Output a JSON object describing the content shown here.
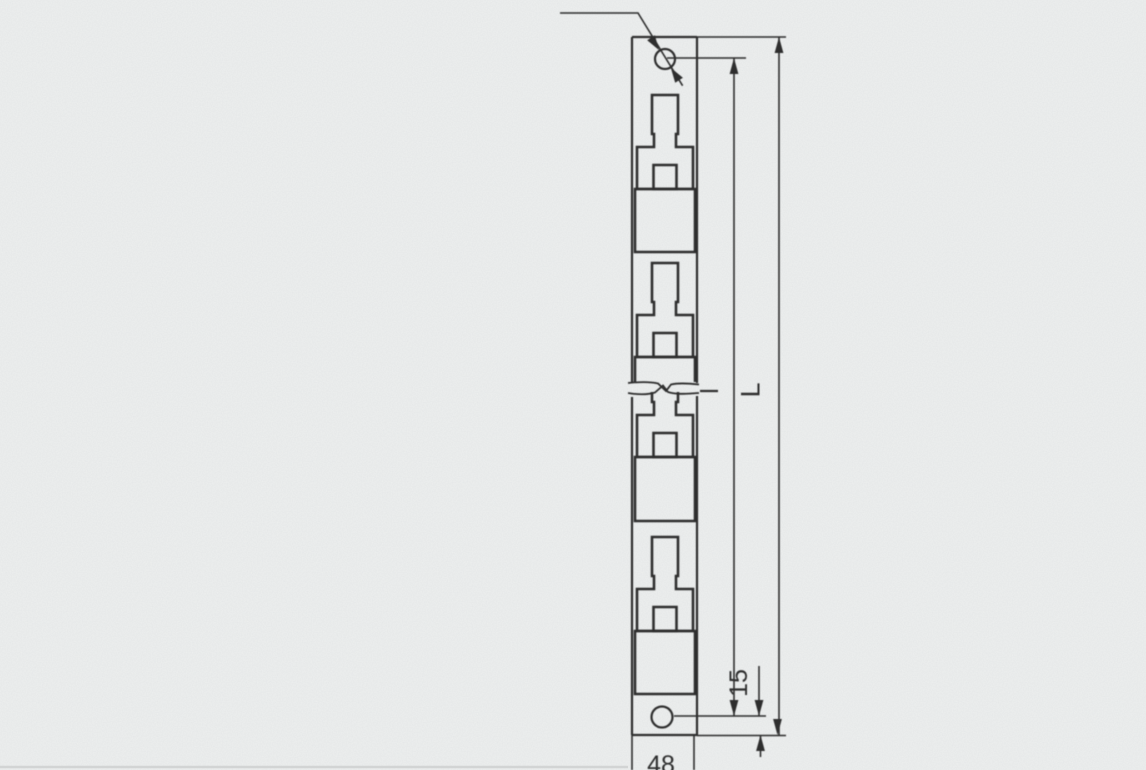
{
  "page": {
    "background_color": "#eef0ef",
    "ink_color": "#2e2e2e",
    "description_of_view": "scanned engineering drawing of a slotted terminal strip, front view"
  },
  "drawing": {
    "dimension_labels": {
      "hole_spacing": "l",
      "overall_length": "L",
      "hole_to_bottom_edge": "15",
      "strip_width": "48"
    }
  }
}
